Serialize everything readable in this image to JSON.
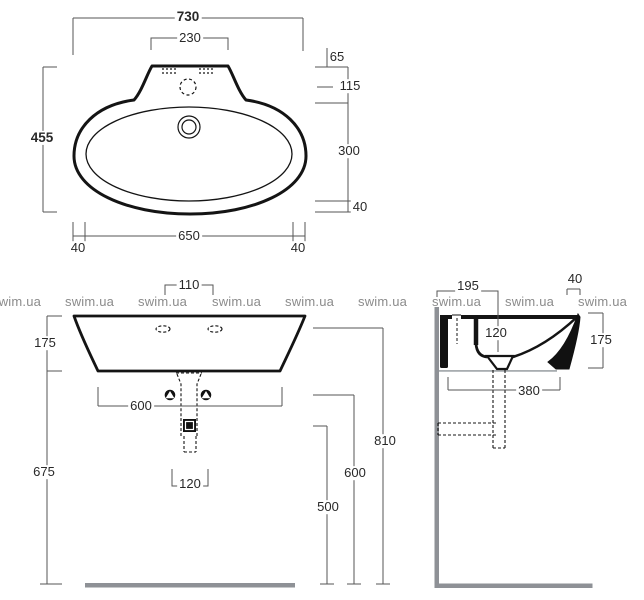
{
  "watermark": {
    "text": "swim.ua"
  },
  "drawing": {
    "title": "wall-hung washbasin dimensional drawing",
    "colors": {
      "line": "#141414",
      "dim_line": "#565656",
      "gray": "#8e9196",
      "watermark": "#8b8b8b"
    },
    "views": {
      "top": {
        "overall_width": "730",
        "tap_deck_width": "230",
        "overall_depth": "455",
        "back_edge": "65",
        "tap_hole_offset": "115",
        "bowl_length": "300",
        "front_rim": "40",
        "bottom_width": "650",
        "bottom_left_offset": "40",
        "bottom_right_offset": "40"
      },
      "front": {
        "tap_hole_spacing": "110",
        "body_height": "175",
        "height_under_body": "675",
        "fixing_hole_spacing": "600",
        "drain_offset": "120",
        "trap_outlet_height": "500",
        "inlet_height": "600",
        "rim_height": "810"
      },
      "side": {
        "back_depth": "195",
        "front_edge": "40",
        "bowl_depth": "120",
        "body_height": "175",
        "fixing_depth": "380"
      }
    }
  }
}
